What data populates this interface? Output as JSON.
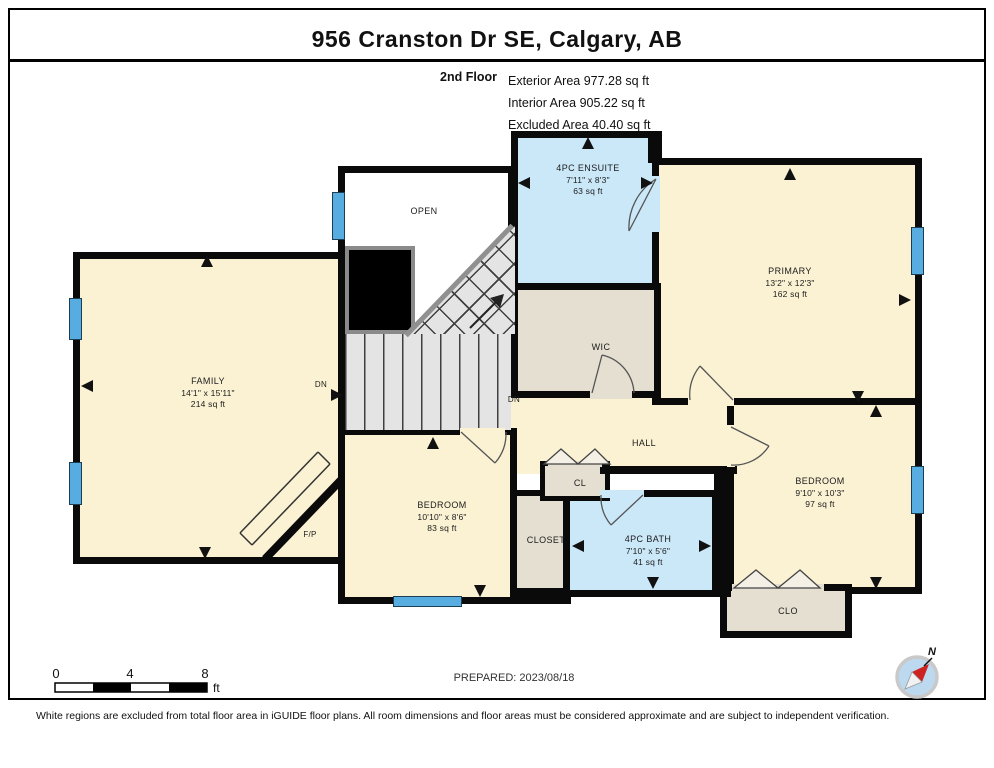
{
  "header": {
    "title": "956 Cranston Dr SE, Calgary, AB"
  },
  "floor_info": {
    "floor": "2nd Floor",
    "lines": [
      "Exterior Area 977.28 sq ft",
      "Interior Area 905.22 sq ft",
      "Excluded Area 40.40 sq ft"
    ]
  },
  "rooms": {
    "ensuite": {
      "name": "4PC ENSUITE",
      "dims": "7'11\" x 8'3\"",
      "area": "63 sq ft"
    },
    "primary": {
      "name": "PRIMARY",
      "dims": "13'2\" x 12'3\"",
      "area": "162 sq ft"
    },
    "family": {
      "name": "FAMILY",
      "dims": "14'1\" x 15'11\"",
      "area": "214 sq ft"
    },
    "bedroom_left": {
      "name": "BEDROOM",
      "dims": "10'10\" x 8'6\"",
      "area": "83 sq ft"
    },
    "bedroom_right": {
      "name": "BEDROOM",
      "dims": "9'10\" x 10'3\"",
      "area": "97 sq ft"
    },
    "bath": {
      "name": "4PC BATH",
      "dims": "7'10\" x 5'6\"",
      "area": "41 sq ft"
    },
    "wic": {
      "name": "WIC"
    },
    "hall": {
      "name": "HALL"
    },
    "open": {
      "name": "OPEN"
    },
    "closet": {
      "name": "CLOSET"
    },
    "cl": {
      "name": "CL"
    },
    "clo": {
      "name": "CLO"
    },
    "fireplace": {
      "name": "F/P"
    }
  },
  "stairs": {
    "down_label_1": "DN",
    "down_label_2": "DN"
  },
  "scale_bar": {
    "ticks": [
      "0",
      "4",
      "8"
    ],
    "unit": "ft"
  },
  "compass": {
    "north_label": "N"
  },
  "footer": {
    "prepared": "PREPARED: 2023/08/18",
    "disclaimer": "White regions are excluded from total floor area in iGUIDE floor plans. All room dimensions and floor areas must be considered approximate and are subject to independent verification."
  },
  "colors": {
    "wall": "#0a0a0a",
    "room_cream": "#fbf2d3",
    "room_blue": "#cbe8f9",
    "room_tan": "#e5dfd1",
    "window_blue": "#57ade0"
  }
}
